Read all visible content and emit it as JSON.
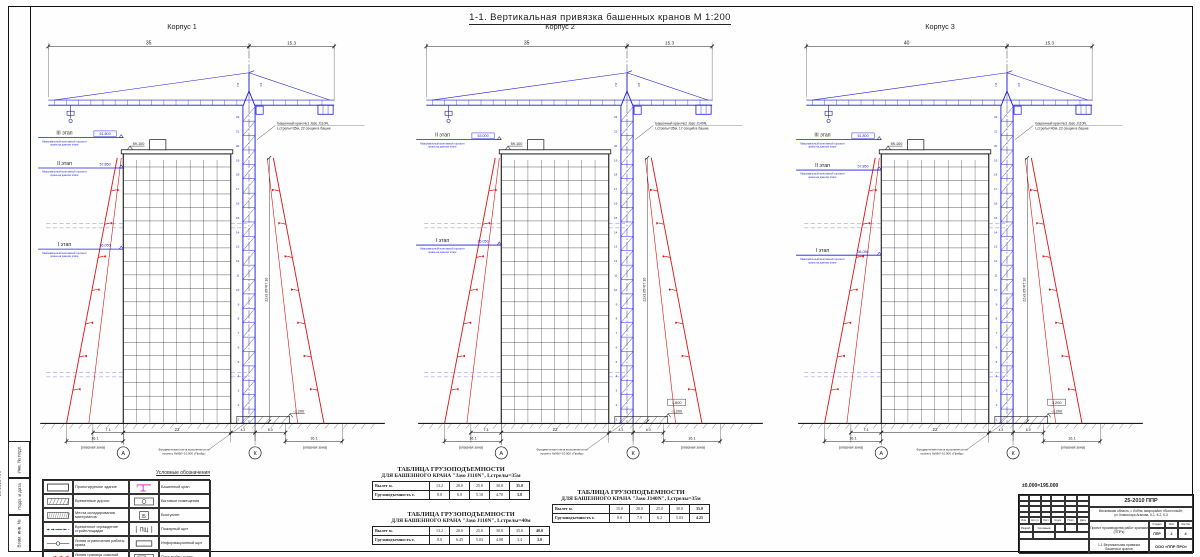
{
  "sheet": {
    "title": "1-1. Вертикальная привязка башенных кранов М 1:200",
    "datum_note": "±0.000=195.000",
    "frame_strips": [
      "Инв. № подл.",
      "Подп. и дата",
      "Взам. инв. №"
    ],
    "edge_code": "25-2010 ППР"
  },
  "corpora": [
    {
      "label": "Корпус 1",
      "crane_note": [
        "Башенный кран №1 Jaso J110N,",
        "Lстрелы=35м, 22 секции в башне"
      ],
      "stages": [
        {
          "name": "III этап",
          "elev": "61.800",
          "boxed": true,
          "y": 116,
          "note": [
            "Максимальный монтажный горизонт",
            "крана на данном этапе"
          ]
        },
        {
          "name": "II этап",
          "elev": "57.850",
          "boxed": false,
          "y": 146,
          "note": [
            "Максимальный монтажный горизонт",
            "крана на данном этапе"
          ]
        },
        {
          "name": "I этап",
          "elev": "36.050",
          "boxed": false,
          "y": 226,
          "note": [
            "Максимальный монтажный горизонт",
            "крана на данном этапе"
          ]
        }
      ],
      "top_dims": {
        "jib": "35",
        "tail": "15.3",
        "aux": [
          "7.8",
          "3.8"
        ]
      },
      "roof_elev": "59.100",
      "base_elev": "-2.200",
      "extra_elev": "",
      "bottom_dims": {
        "d1": "7.1",
        "width": "22",
        "d2": "4.3",
        "d3": "6.0",
        "zoneL": "16.1",
        "zoneR": "16.1"
      },
      "zone_label": "(опасная зона)",
      "axes": [
        "А",
        "К"
      ],
      "tower_dim": "22х3.05=67.10",
      "sections": 22,
      "foundation_note": [
        "Фундаментная плита выполняется по",
        "проекту №96/У-10.000 «Прайд»"
      ]
    },
    {
      "label": "Корпус 2",
      "crane_note": [
        "Башенный кран №2 Jaso J140N,",
        "Lстрелы=35м, 17 секций в башне"
      ],
      "stages": [
        {
          "name": "II этап",
          "elev": "63.000",
          "boxed": true,
          "y": 118,
          "note": [
            "Максимальный монтажный горизонт",
            "крана на данном этапе"
          ]
        },
        {
          "name": "I этап",
          "elev": "36.050",
          "boxed": false,
          "y": 222,
          "note": [
            "Максимальный монтажный горизонт",
            "крана на данном этапе"
          ]
        }
      ],
      "top_dims": {
        "jib": "35",
        "tail": "15.3",
        "aux": [
          "7.8",
          "3.8"
        ]
      },
      "roof_elev": "59.100",
      "base_elev": "-2.200",
      "extra_elev": "1.800",
      "bottom_dims": {
        "d1": "7.1",
        "width": "22",
        "d2": "4.3",
        "d3": "6.0",
        "zoneL": "16.1",
        "zoneR": "16.1"
      },
      "zone_label": "(опасная зона)",
      "axes": [
        "А",
        "К"
      ],
      "tower_dim": "22х3.05=67.10",
      "sections": 22,
      "foundation_note": [
        "Фундаментная плита выполняется по",
        "проекту №96/У-10.000 «Прайд»"
      ]
    },
    {
      "label": "Корпус 3",
      "crane_note": [
        "Башенный кран №3 Jaso J110N,",
        "Lстрелы=40м, 22 секции в башне"
      ],
      "stages": [
        {
          "name": "III этап",
          "elev": "61.800",
          "boxed": true,
          "y": 118,
          "note": [
            "Максимальный монтажный горизонт",
            "крана на данном этапе"
          ]
        },
        {
          "name": "II этап",
          "elev": "57.850",
          "boxed": false,
          "y": 148,
          "note": [
            "Максимальный монтажный горизонт",
            "крана на данном этапе"
          ]
        },
        {
          "name": "I этап",
          "elev": "36.050",
          "boxed": false,
          "y": 232,
          "note": [
            "Максимальный монтажный горизонт",
            "крана на данном этапе"
          ]
        }
      ],
      "top_dims": {
        "jib": "40",
        "tail": "15.3",
        "aux": [
          "7.8",
          "3.8"
        ]
      },
      "roof_elev": "59.100",
      "base_elev": "-2.200",
      "extra_elev": "3.200",
      "bottom_dims": {
        "d1": "7.1",
        "width": "22",
        "d2": "4.3",
        "d3": "6.0",
        "zoneL": "16.1",
        "zoneR": "16.1"
      },
      "zone_label": "(опасная зона)",
      "axes": [
        "А",
        "К"
      ],
      "tower_dim": "22х3.05=67.10",
      "sections": 22,
      "foundation_note": [
        "Фундаментная плита выполняется по",
        "проекту №96/У-10.000 «Прайд»"
      ]
    }
  ],
  "legend": {
    "title": "Условные обозначения",
    "left": [
      {
        "sym": "bldg",
        "label": "Проектируемое здание"
      },
      {
        "sym": "road",
        "label": "Временные дороги"
      },
      {
        "sym": "storage",
        "label": "Места складирования материалов"
      },
      {
        "sym": "fence",
        "label": "Временное ограждение стройплощадки"
      },
      {
        "sym": "limit",
        "label": "Линия ограничения работы крана"
      },
      {
        "sym": "danger",
        "label": "Линия границы опасной зоны работы крана"
      },
      {
        "sym": "arrow",
        "label": "Направление движения автотранспорта"
      }
    ],
    "right": [
      {
        "sym": "crane",
        "label": "Башенный кран"
      },
      {
        "sym": "household",
        "label": "Бытовые помещения"
      },
      {
        "sym": "wc",
        "label": "Биотуалет"
      },
      {
        "sym": "fire",
        "label": "Пожарный щит"
      },
      {
        "sym": "info",
        "label": "Информационный щит"
      },
      {
        "sym": "wash",
        "label": "Пост мойки колес"
      },
      {
        "sym": "danger2",
        "label": "Граница опасной зоны вблизи строящегося здания"
      }
    ]
  },
  "load_tables": [
    {
      "title1": "ТАБЛИЦА ГРУЗОПОДЪЕМНОСТИ",
      "title2": "ДЛЯ БАШЕННОГО КРАНА \"Jaso J110N\", Lстрелы=35м",
      "row1_label": "Вылет м.",
      "row1": [
        "13.2",
        "20.0",
        "25.0",
        "30.0",
        "35.0"
      ],
      "row2_label": "Грузоподъемность т.",
      "row2": [
        "8.0",
        "6.0",
        "5.10",
        "4.70",
        "3.8"
      ]
    },
    {
      "title1": "ТАБЛИЦА ГРУЗОПОДЪЕМНОСТИ",
      "title2": "ДЛЯ БАШЕННОГО КРАНА \"Jaso J110N\", Lстрелы=40м",
      "row1_label": "Вылет м.",
      "row1": [
        "13.2",
        "20.0",
        "25.0",
        "30.0",
        "35.0",
        "40.0"
      ],
      "row2_label": "Грузоподъемность т.",
      "row2": [
        "8.0",
        "6.45",
        "5.03",
        "4.08",
        "3.4",
        "3.0"
      ]
    },
    {
      "title1": "ТАБЛИЦА ГРУЗОПОДЪЕМНОСТИ",
      "title2": "ДЛЯ БАШЕННОГО КРАНА \"Jaso J140N\", Lстрелы=35м",
      "row1_label": "Вылет м.",
      "row1": [
        "15.0",
        "20.0",
        "25.0",
        "30.0",
        "35.0"
      ],
      "row2_label": "Грузоподъемность т.",
      "row2": [
        "8.0",
        "7.9",
        "6.2",
        "5.03",
        "4.25"
      ]
    }
  ],
  "titleblock": {
    "code": "25-2010 ППР",
    "object_line1": "Московская область, г. Лобня, микрорайон «Восточный»,",
    "object_line2": "ул. Комиссара Агапова, К-1, К-2, К-3",
    "doc_type": "Проект производства работ кранами (ППРк)",
    "stage_label": "Стадия",
    "sheet_label": "Лист",
    "sheets_label": "Листов",
    "stage": "ППР",
    "sheet": "2",
    "sheets": "4",
    "sheet_title": "1-1 Вертикальная привязка башенных кранов",
    "company": "ООО «ППР ПРО»",
    "rev_headers": [
      "Изм.",
      "Кол.уч",
      "Лист",
      "№док.",
      "Подп.",
      "Дата"
    ],
    "dev_label": "Разраб.",
    "dev_name": "Соловьев"
  },
  "colors": {
    "crane_blue": "#1c1cd8",
    "danger_red": "#e21313",
    "magenta": "#cc00cc",
    "black": "#1b1b1b"
  }
}
